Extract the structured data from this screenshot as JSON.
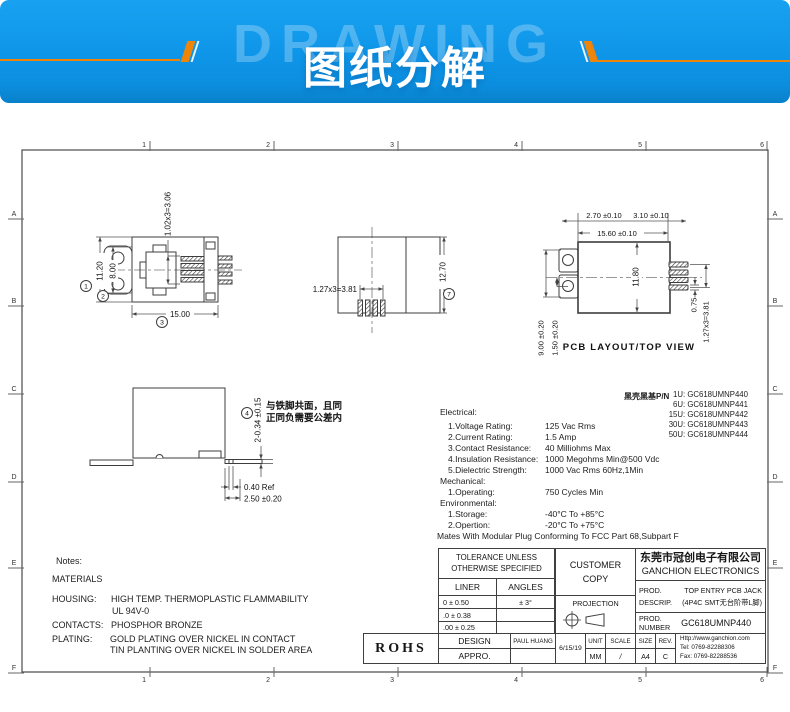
{
  "banner": {
    "watermark": "DRAWING",
    "title": "图纸分解"
  },
  "sheet": {
    "zones_top": [
      "1",
      "2",
      "3",
      "4",
      "5",
      "6"
    ],
    "zones_bottom": [
      "1",
      "2",
      "3",
      "4",
      "5",
      "6"
    ],
    "zones_left": [
      "A",
      "B",
      "C",
      "D",
      "E",
      "F"
    ],
    "zones_right": [
      "A",
      "B",
      "C",
      "D",
      "E",
      "F"
    ]
  },
  "views": {
    "top_view": {
      "dim_height": "11.20",
      "dim_inner": "8.00",
      "dim_width": "15.00",
      "dim_pitch": "1.02x3=3.06",
      "balloon1": "1",
      "balloon2": "2",
      "balloon3": "3"
    },
    "front_view": {
      "dim_pitch": "1.27x3=3.81",
      "dim_height": "12.70",
      "balloon": "7"
    },
    "pcb_view": {
      "caption": "PCB LAYOUT/TOP VIEW",
      "dim_a": "2.70 ±0.10",
      "dim_b": "3.10 ±0.10",
      "dim_c": "15.60 ±0.10",
      "dim_d": "11.80",
      "dim_e": "9.00 ±0.20",
      "dim_f": "1.50 ±0.20",
      "dim_g": "0.75",
      "dim_h": "1.27x3=3.81"
    },
    "side_view": {
      "dim_a": "2-0.34 ±0.15",
      "dim_b": "0.40 Ref",
      "dim_c": "2.50 ±0.20",
      "balloon": "4",
      "note1": "与铁脚共面，且同",
      "note2": "正同负需要公差内"
    }
  },
  "pn": {
    "title": "黑壳黑基P/N",
    "items": [
      "1U: GC618UMNP440",
      "6U: GC618UMNP441",
      "15U: GC618UMNP442",
      "30U: GC618UMNP443",
      "50U: GC618UMNP444"
    ]
  },
  "specs": {
    "electrical_title": "Electrical:",
    "electrical": [
      {
        "label": "1.Voltage Rating:",
        "value": "125 Vac Rms"
      },
      {
        "label": "2.Current Rating:",
        "value": "1.5 Amp"
      },
      {
        "label": "3.Contact Resistance:",
        "value": "40 Milliohms Max"
      },
      {
        "label": "4.Insulation Resistance:",
        "value": "1000 Megohms Min@500 Vdc"
      },
      {
        "label": "5.Dielectric Strength:",
        "value": "1000 Vac Rms 60Hz,1Min"
      }
    ],
    "mechanical_title": "Mechanical:",
    "mechanical": [
      {
        "label": "1.Operating:",
        "value": "750 Cycles Min"
      }
    ],
    "environmental_title": "Environmental:",
    "environmental": [
      {
        "label": "1.Storage:",
        "value": "-40°C To +85°C"
      },
      {
        "label": "2.Opertion:",
        "value": "-20°C To +75°C"
      }
    ],
    "mates_note": "Mates With Modular Plug Conforming To FCC Part 68,Subpart F"
  },
  "notes": {
    "title": "Notes:",
    "materials": "MATERIALS",
    "housing_label": "HOUSING:",
    "housing_value1": "HIGH TEMP. THERMOPLASTIC FLAMMABILITY",
    "housing_value2": "UL 94V-0",
    "contacts_label": "CONTACTS:",
    "contacts_value": "PHOSPHOR BRONZE",
    "plating_label": "PLATING:",
    "plating_value1": "GOLD PLATING OVER NICKEL IN CONTACT",
    "plating_value2": "TIN PLANTING OVER NICKEL IN SOLDER AREA"
  },
  "titleblock": {
    "tolerance_line1": "TOLERANCE UNLESS",
    "tolerance_line2": "OTHERWISE SPECIFIED",
    "liner": "LINER",
    "angles": "ANGLES",
    "tol1_liner": "0  ±  0.50",
    "tol1_angles": "± 3°",
    "tol2_liner": ".0  ±  0.38",
    "tol2_angles": "",
    "tol3_liner": ".00 ±  0.25",
    "tol3_angles": "",
    "design": "DESIGN",
    "designer": "PAUL HUANG",
    "appro": "APPRO.",
    "appro_value": "",
    "customer1": "CUSTOMER",
    "customer2": "COPY",
    "projection": "PROJECTION",
    "date": "6/15/19",
    "unit": "UNIT",
    "unit_value": "MM",
    "scale": "SCALE",
    "scale_value": "/",
    "size": "SIZE",
    "size_value": "A4",
    "rev": "REV.",
    "rev_value": "C",
    "company_cn": "东莞市冠创电子有限公司",
    "company_en": "GANCHION ELECTRONICS",
    "prod1": "PROD.",
    "descrip": "DESCRIP.",
    "descrip_value1": "TOP ENTRY PCB JACK",
    "descrip_value2": "(4P4C SMT无台阶带L脚)",
    "prod2": "PROD.",
    "number": "NUMBER",
    "part_number": "GC618UMNP440",
    "website": "Http://www.ganchion.com",
    "tel": "Tel:  0769-82288306",
    "fax": "Fax: 0769-82288536",
    "rohs": "ROHS"
  }
}
